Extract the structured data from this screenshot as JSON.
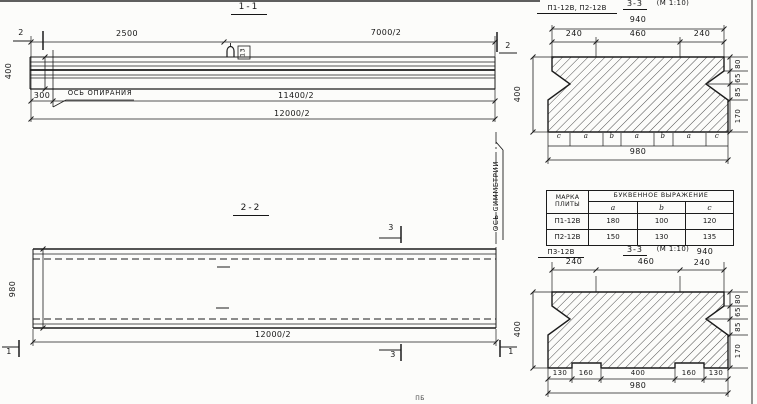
{
  "s11": {
    "title": "1-1",
    "cut_left": "2",
    "cut_right": "2",
    "dim_2500": "2500",
    "dim_7000": "7000/2",
    "dim_height": "400",
    "dim_300": "300",
    "axis_label": "ОСЬ ОПИРАНИЯ",
    "dim_11400": "11400/2",
    "dim_12000": "12000/2",
    "loop_mark": "13"
  },
  "s22": {
    "title": "2-2",
    "cut3_top": "3",
    "cut3_bottom": "3",
    "cut1_left": "1",
    "cut1_right": "1",
    "dim_height": "980",
    "dim_length": "12000/2",
    "axis_label": "ОСЬ СИММЕТРИИ"
  },
  "cs1": {
    "label": "П1-12В, П2-12В",
    "title": "3-3",
    "scale": "(М 1:10)",
    "dim_overall_top": "940",
    "dims_top": [
      "240",
      "460",
      "240"
    ],
    "dim_height": "400",
    "dims_right": [
      "80",
      "65",
      "85",
      "170"
    ],
    "letters": [
      "c",
      "a",
      "b",
      "a",
      "b",
      "a",
      "c"
    ],
    "dim_overall_bottom": "980"
  },
  "table": {
    "h_mark": "МАРКА ПЛИТЫ",
    "h_expr": "БУКВЕННОЕ ВЫРАЖЕНИЕ",
    "h_a": "a",
    "h_b": "b",
    "h_c": "c",
    "rows": [
      {
        "mark": "П1-12В",
        "a": "180",
        "b": "100",
        "c": "120"
      },
      {
        "mark": "П2-12В",
        "a": "150",
        "b": "130",
        "c": "135"
      }
    ]
  },
  "cs2": {
    "label": "П3-12В",
    "title": "3-3",
    "scale": "(М 1:10)",
    "dim_overall_top": "940",
    "dims_top": [
      "240",
      "460",
      "240"
    ],
    "dim_height": "400",
    "dims_right": [
      "80",
      "65",
      "85",
      "170"
    ],
    "dims_bottom": [
      "130",
      "160",
      "400",
      "160",
      "130"
    ],
    "dim_overall_bottom": "980"
  },
  "misc": {
    "partial_bottom": "ПБ"
  }
}
